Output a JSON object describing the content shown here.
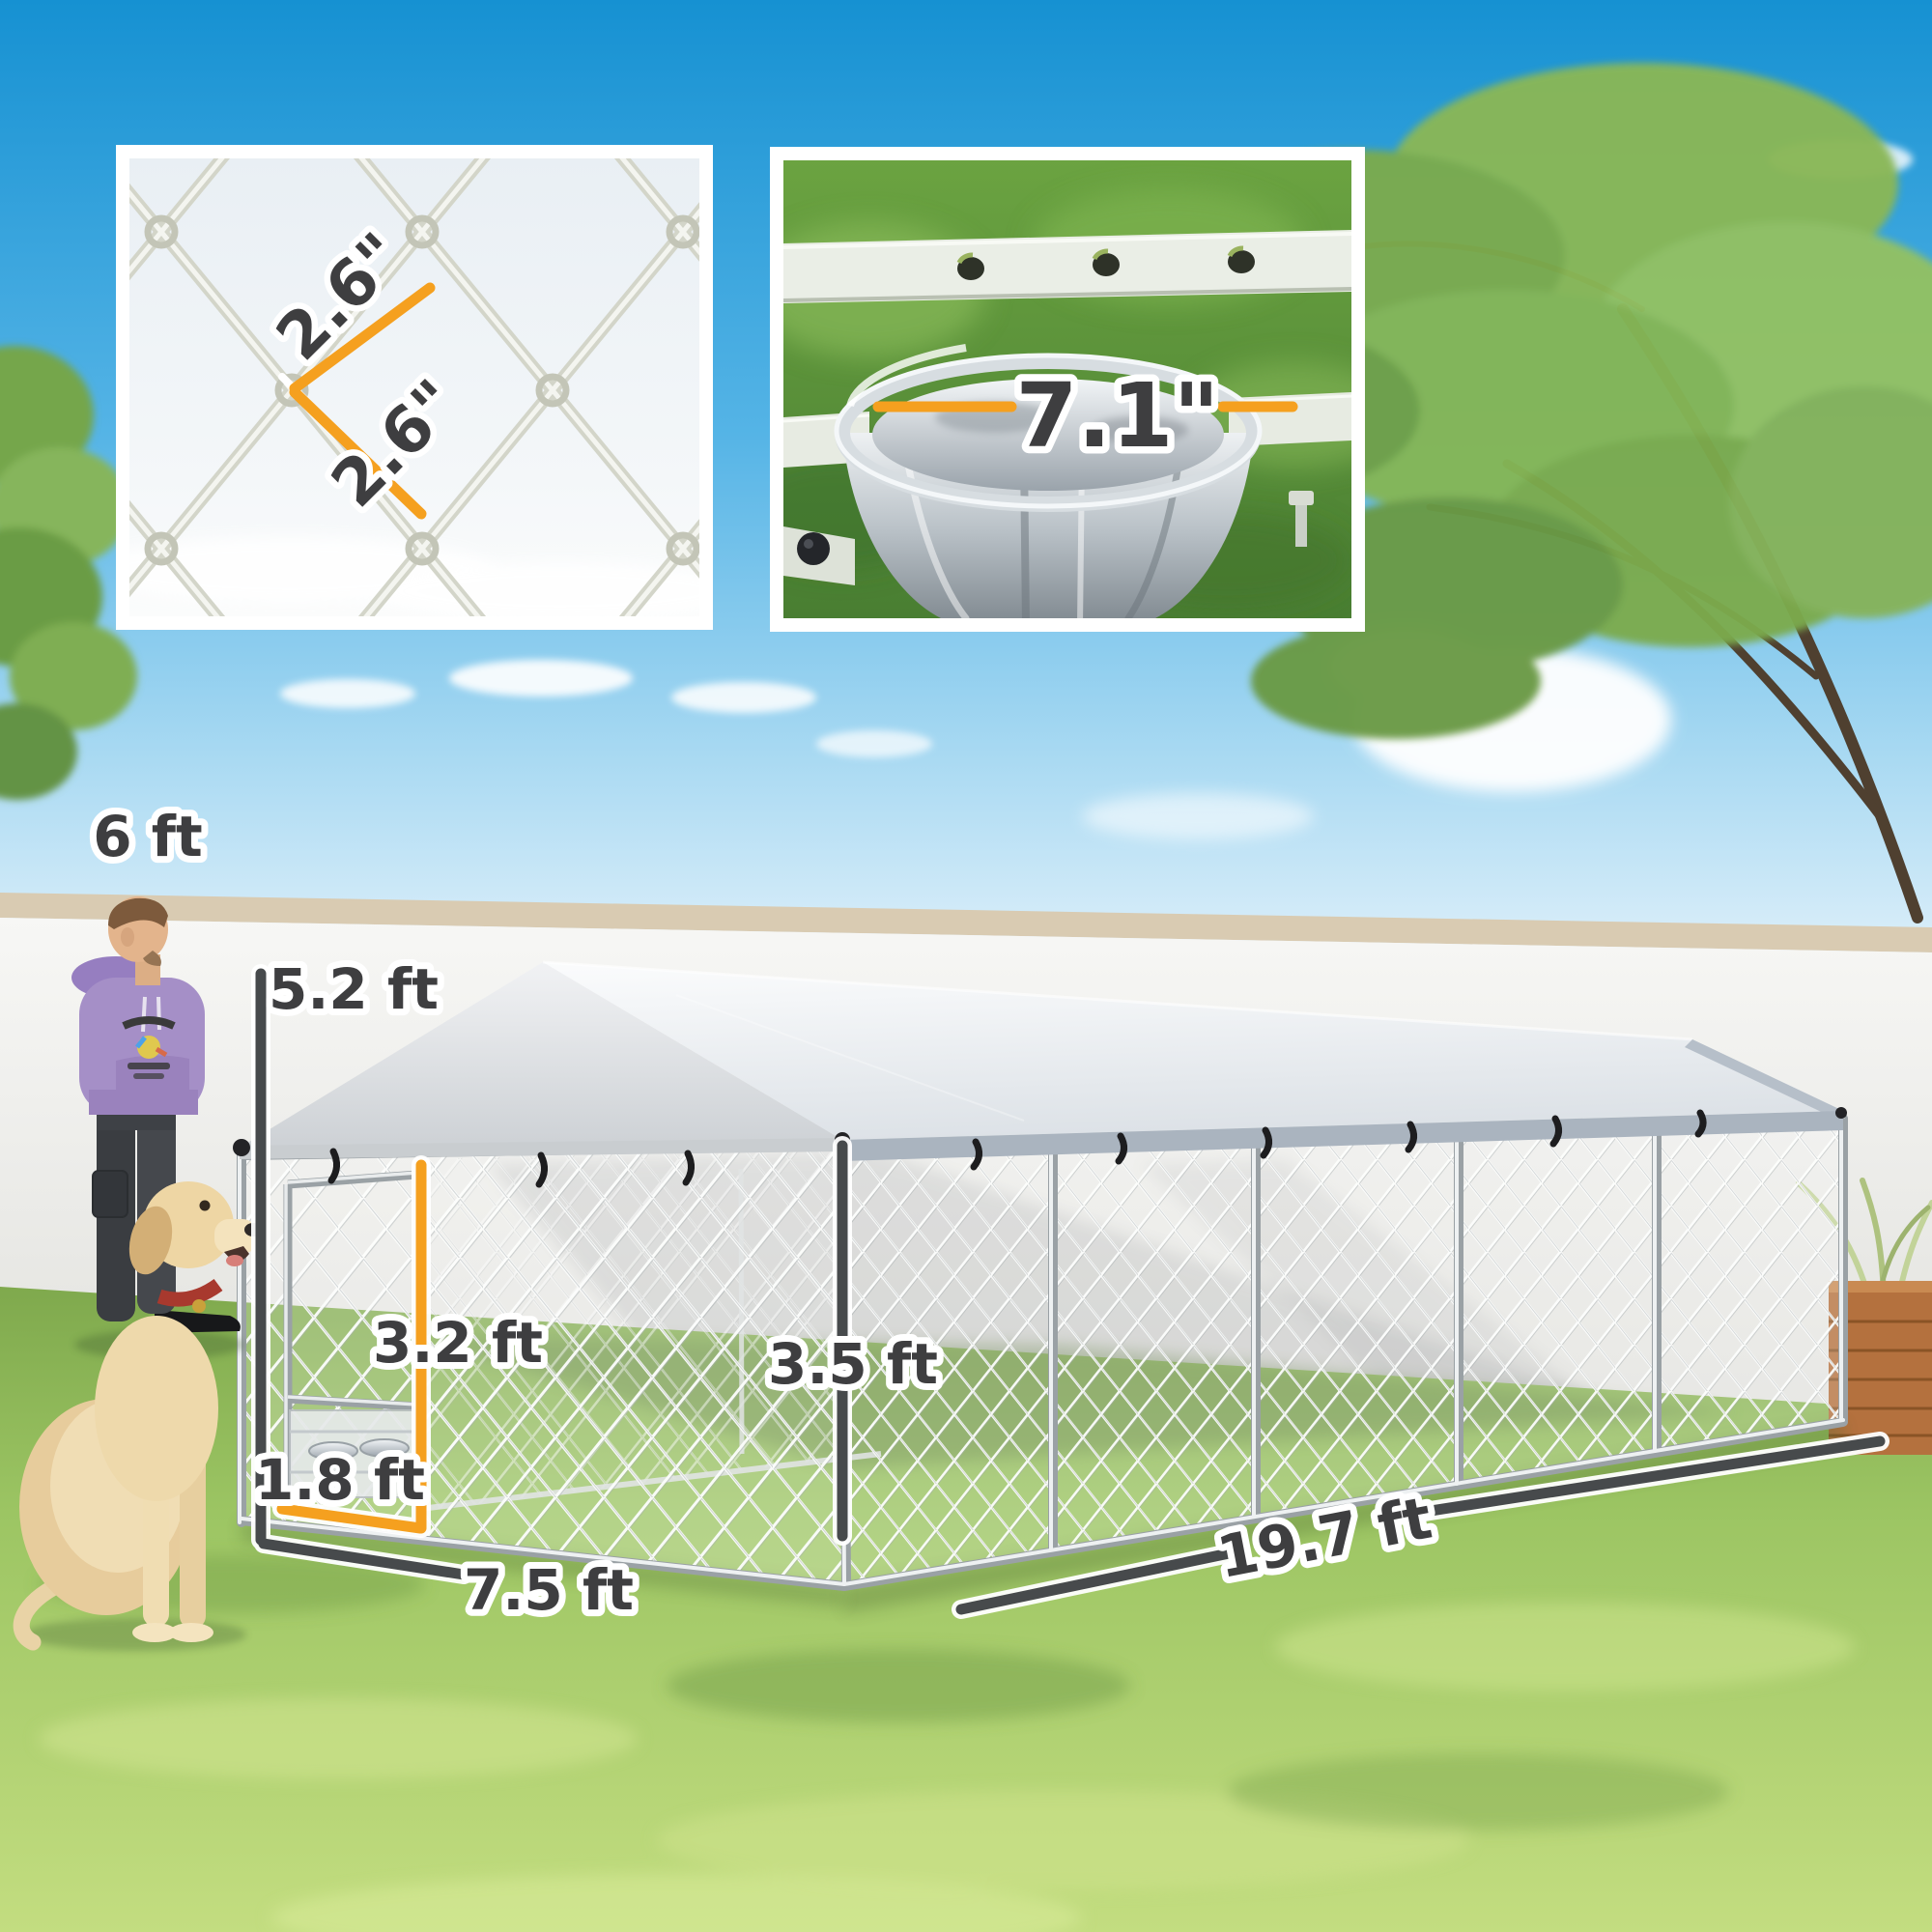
{
  "scene": {
    "type": "outdoor dog kennel product photo with dimension callouts",
    "objects": [
      "backyard wall",
      "lawn",
      "man",
      "labrador dog",
      "chain-link dog kennel with canopy roof",
      "wooden planter"
    ]
  },
  "annotations": {
    "wall_height": "6 ft",
    "kennel_height": "5.2 ft",
    "door_height": "3.2 ft",
    "door_width": "1.8 ft",
    "side_height": "3.5 ft",
    "kennel_width": "7.5 ft",
    "kennel_length": "19.7 ft"
  },
  "insets": {
    "mesh_detail": {
      "labels": [
        "2.6\"",
        "2.6\""
      ]
    },
    "bowl_detail": {
      "label": "7.1\""
    }
  },
  "colors": {
    "accent_orange": "#F5A01F",
    "label_dark": "#3E3E40",
    "halo_white": "#FFFFFF",
    "sky_blue": "#1691D2",
    "grass_green": "#9CC563",
    "canopy_gray": "#E3E7EB",
    "wall_white": "#F3F3F1"
  }
}
